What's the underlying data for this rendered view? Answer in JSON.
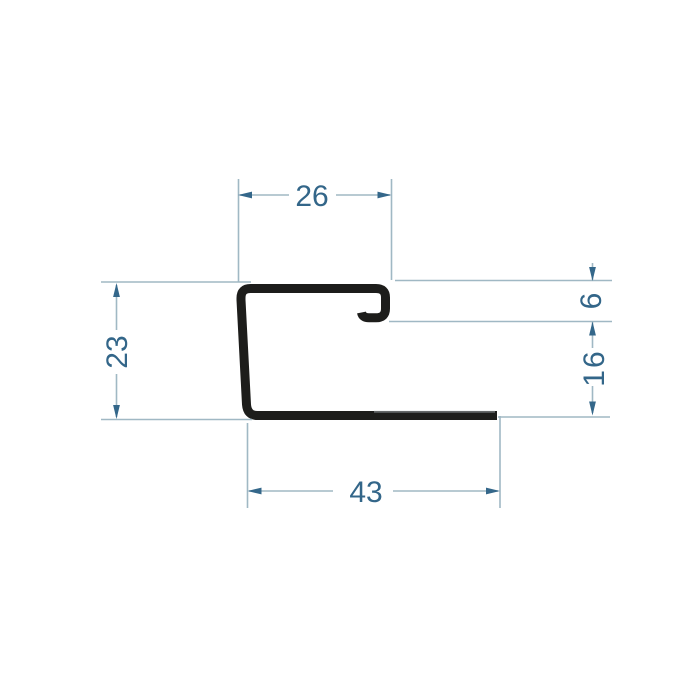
{
  "meta": {
    "type": "technical-drawing",
    "subject": "J-shaped sheet-metal trim profile cross-section with dimension annotations"
  },
  "colors": {
    "background": "#ffffff",
    "profile": "#1d1d1b",
    "seam": "#7d8284",
    "dimension_line": "#a0b8c4",
    "arrow": "#34678a",
    "text": "#336689"
  },
  "dimensions": {
    "top_width": "26",
    "left_height": "23",
    "right_hook_depth": "6",
    "right_lower_height": "16",
    "bottom_width": "43"
  }
}
